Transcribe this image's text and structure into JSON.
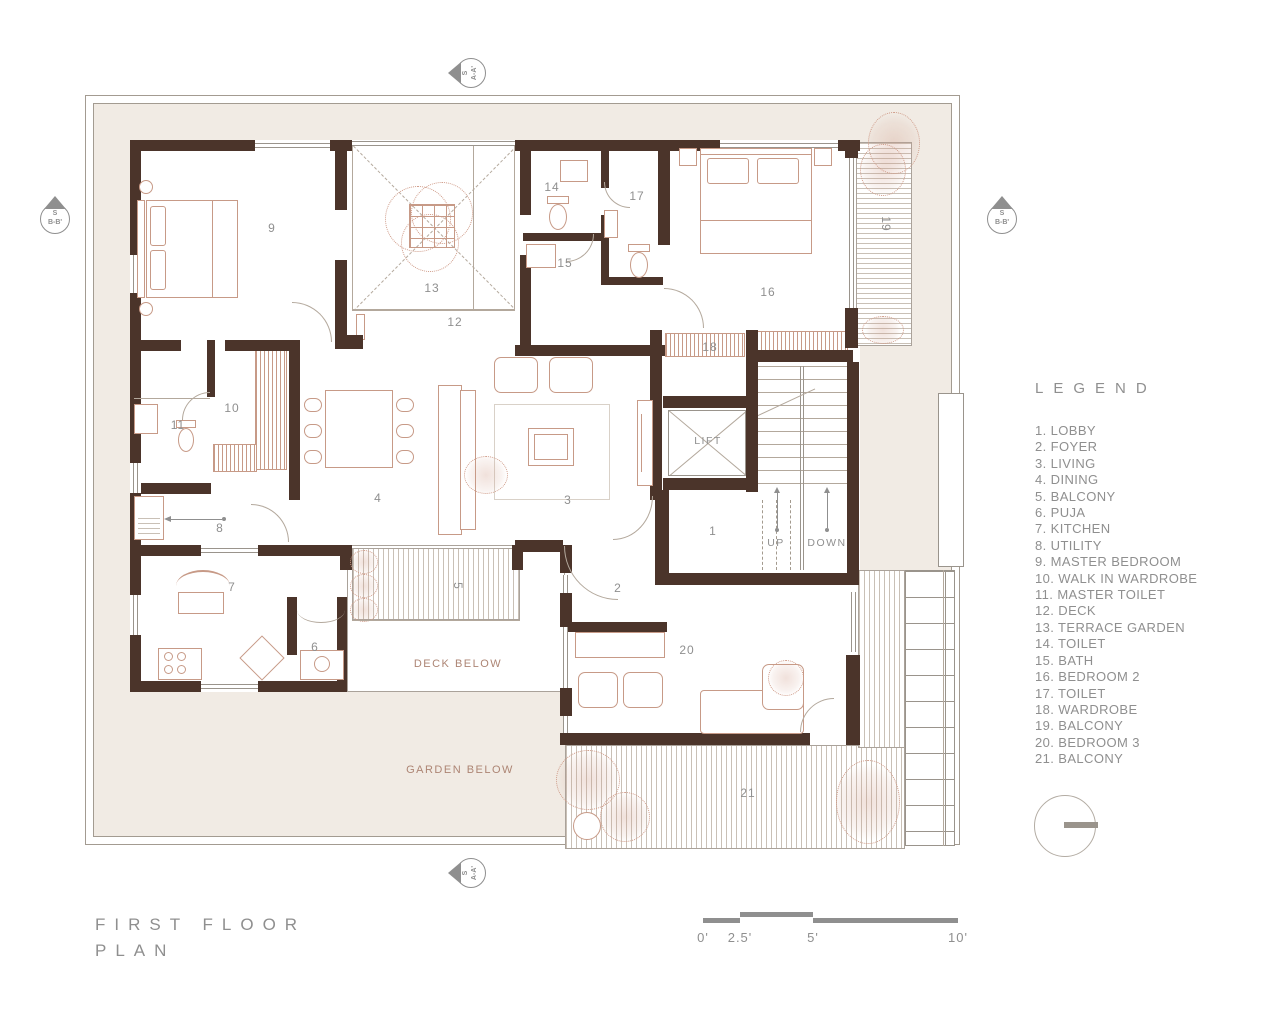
{
  "title": {
    "line1": "FIRST FLOOR",
    "line2": "PLAN"
  },
  "legend": {
    "title": "LEGEND",
    "items": [
      "1. LOBBY",
      "2. FOYER",
      "3. LIVING",
      "4. DINING",
      "5. BALCONY",
      "6. PUJA",
      "7. KITCHEN",
      "8. UTILITY",
      "9. MASTER BEDROOM",
      "10. WALK IN WARDROBE",
      "11. MASTER TOILET",
      "12. DECK",
      "13. TERRACE GARDEN",
      "14. TOILET",
      "15. BATH",
      "16. BEDROOM 2",
      "17. TOILET",
      "18. WARDROBE",
      "19. BALCONY",
      "20. BEDROOM 3",
      "21. BALCONY"
    ]
  },
  "scale_bar": {
    "labels": [
      "0'",
      "2.5'",
      "5'",
      "10'"
    ]
  },
  "markers": {
    "s": "S",
    "aa": "A-A'",
    "bb": "B-B'"
  },
  "plan": {
    "room_numbers": {
      "r1": "1",
      "r2": "2",
      "r3": "3",
      "r4": "4",
      "r5": "5",
      "r6": "6",
      "r7": "7",
      "r8": "8",
      "r9": "9",
      "r10": "10",
      "r11": "11",
      "r12": "12",
      "r13": "13",
      "r14": "14",
      "r15": "15",
      "r16": "16",
      "r17": "17",
      "r18": "18",
      "r19": "19",
      "r20": "20",
      "r21": "21"
    },
    "labels": {
      "lift": "LIFT",
      "up": "UP",
      "down": "DOWN",
      "deck_below": "DECK BELOW",
      "garden_below": "GARDEN BELOW"
    }
  },
  "colors": {
    "wall": "#4b342a",
    "site": "#f1ebe4",
    "furniture": "#c79a87",
    "text": "#8f8f8f"
  }
}
